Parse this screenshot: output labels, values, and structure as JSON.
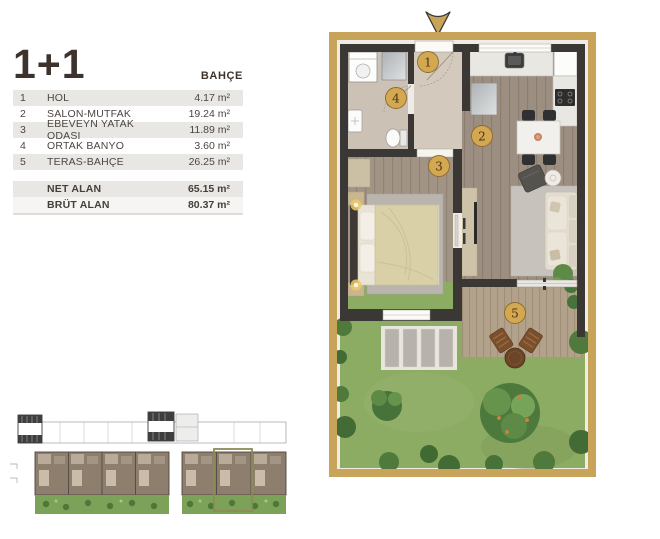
{
  "info": {
    "title": "1+1",
    "variant_label": "BAHÇE",
    "rooms": [
      {
        "no": "1",
        "name": "HOL",
        "area": "4.17 m²"
      },
      {
        "no": "2",
        "name": "SALON-MUTFAK",
        "area": "19.24 m²"
      },
      {
        "no": "3",
        "name": "EBEVEYN YATAK ODASI",
        "area": "11.89 m²"
      },
      {
        "no": "4",
        "name": "ORTAK BANYO",
        "area": "3.60 m²"
      },
      {
        "no": "5",
        "name": "TERAS-BAHÇE",
        "area": "26.25 m²"
      }
    ],
    "summary": [
      {
        "label": "NET ALAN",
        "area": "65.15 m²"
      },
      {
        "label": "BRÜT ALAN",
        "area": "80.37 m²"
      }
    ]
  },
  "plan": {
    "badges": [
      {
        "label": "1"
      },
      {
        "label": "2"
      },
      {
        "label": "3"
      },
      {
        "label": "4"
      },
      {
        "label": "5"
      }
    ]
  },
  "colors": {
    "accent_gold": "#c7a45a",
    "wall": "#3a3734",
    "grass": "#8cab63",
    "row_alt": "#e9e7e4",
    "site_highlight": "#8b8b55",
    "text": "#453f3a"
  }
}
